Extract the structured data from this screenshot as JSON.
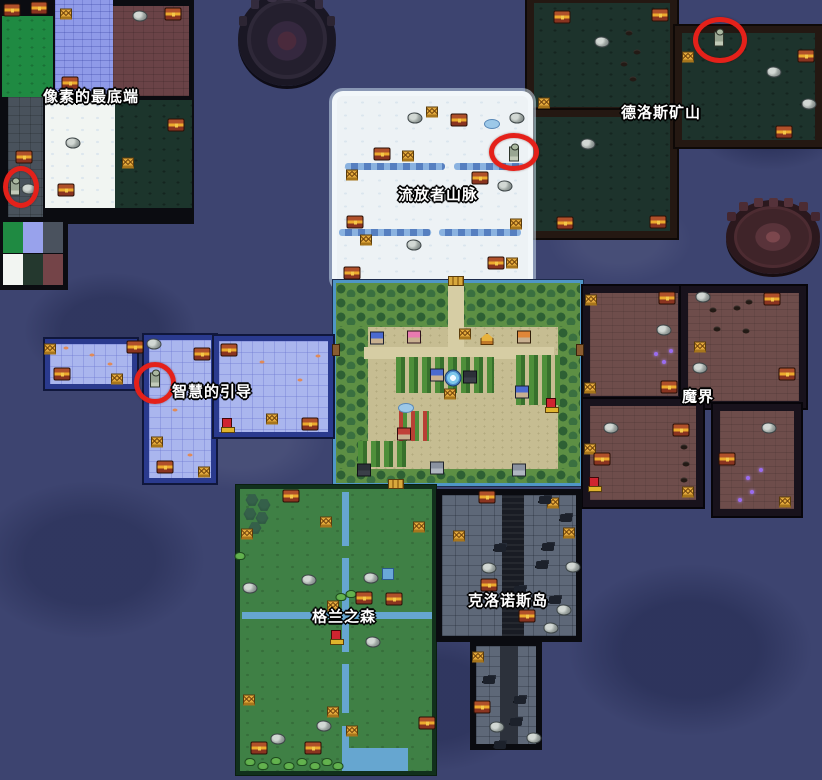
{
  "map": {
    "width": 822,
    "height": 780
  },
  "labels": [
    {
      "id": "pixel-bottom",
      "text": "像素的最底端",
      "x": 91,
      "y": 96
    },
    {
      "id": "delos-mine",
      "text": "德洛斯矿山",
      "x": 661,
      "y": 112
    },
    {
      "id": "exile-mountains",
      "text": "流放者山脉",
      "x": 438,
      "y": 194
    },
    {
      "id": "wisdom-guidance",
      "text": "智慧的引导",
      "x": 212,
      "y": 391
    },
    {
      "id": "demon-realm",
      "text": "魔界",
      "x": 698,
      "y": 396
    },
    {
      "id": "kronos-island",
      "text": "克洛诺斯岛",
      "x": 508,
      "y": 600
    },
    {
      "id": "gran-forest",
      "text": "格兰之森",
      "x": 344,
      "y": 616
    }
  ],
  "markers": {
    "red_circles": [
      {
        "x": 21,
        "y": 187,
        "rx": 18,
        "ry": 21
      },
      {
        "x": 514,
        "y": 152,
        "rx": 25,
        "ry": 19
      },
      {
        "x": 720,
        "y": 40,
        "rx": 27,
        "ry": 23
      },
      {
        "x": 155,
        "y": 383,
        "rx": 21,
        "ry": 21
      }
    ]
  },
  "icons": {
    "chest": "treasure-chest-icon",
    "sign": "gold-marker-icon",
    "rock": "rock-icon",
    "statue": "statue-icon",
    "totem": "red-totem-icon",
    "bush": "bush-icon",
    "pine": "pine-tree-icon",
    "sparkle": "purple-sparkle-icon",
    "orespot": "ore-icon",
    "fish": "fish-icon",
    "debris": "debris-icon",
    "pond": "pond-icon",
    "bluesq": "water-tile-icon",
    "dock": "dock-icon",
    "bridge": "bridge-icon",
    "fountain": "fountain-icon",
    "tent": "tent-icon",
    "houseblue": "house-icon",
    "housepink": "house-icon",
    "houseorange": "house-icon",
    "housered": "house-icon",
    "housedark": "house-icon",
    "housegray": "house-icon"
  },
  "colors": {
    "water": "#3d4470",
    "red_marker": "#e4211a",
    "label_text": "#ffffff",
    "chest_gold": "#edab2e",
    "snow": "#edf2f5",
    "wisdom_floor": "#aab6ee",
    "mine_floor": "#1d332c",
    "demon_floor": "#6e4d4b",
    "kronos_floor": "#5e6878",
    "forest_floor": "#3f8045",
    "village_ground": "#c6bd92",
    "river": "#66a6d0"
  },
  "sprites": [
    {
      "t": "chest",
      "x": 12,
      "y": 10
    },
    {
      "t": "chest",
      "x": 39,
      "y": 8
    },
    {
      "t": "sign",
      "x": 66,
      "y": 14
    },
    {
      "t": "rock",
      "x": 140,
      "y": 16
    },
    {
      "t": "chest",
      "x": 173,
      "y": 14
    },
    {
      "t": "chest",
      "x": 70,
      "y": 83
    },
    {
      "t": "rock",
      "x": 73,
      "y": 143
    },
    {
      "t": "chest",
      "x": 66,
      "y": 190
    },
    {
      "t": "chest",
      "x": 176,
      "y": 125
    },
    {
      "t": "sign",
      "x": 128,
      "y": 163
    },
    {
      "t": "chest",
      "x": 24,
      "y": 157
    },
    {
      "t": "statue",
      "x": 15,
      "y": 188
    },
    {
      "t": "rock",
      "x": 29,
      "y": 189
    },
    {
      "t": "chest",
      "x": 562,
      "y": 17
    },
    {
      "t": "chest",
      "x": 660,
      "y": 15
    },
    {
      "t": "rock",
      "x": 602,
      "y": 42
    },
    {
      "t": "orespot",
      "x": 629,
      "y": 33
    },
    {
      "t": "orespot",
      "x": 637,
      "y": 52
    },
    {
      "t": "orespot",
      "x": 624,
      "y": 64
    },
    {
      "t": "orespot",
      "x": 633,
      "y": 79
    },
    {
      "t": "sign",
      "x": 544,
      "y": 103
    },
    {
      "t": "rock",
      "x": 588,
      "y": 144
    },
    {
      "t": "chest",
      "x": 565,
      "y": 223
    },
    {
      "t": "chest",
      "x": 658,
      "y": 222
    },
    {
      "t": "statue",
      "x": 719,
      "y": 39
    },
    {
      "t": "sign",
      "x": 688,
      "y": 57
    },
    {
      "t": "chest",
      "x": 806,
      "y": 56
    },
    {
      "t": "rock",
      "x": 774,
      "y": 72
    },
    {
      "t": "rock",
      "x": 809,
      "y": 104
    },
    {
      "t": "chest",
      "x": 784,
      "y": 132
    },
    {
      "t": "rock",
      "x": 415,
      "y": 118
    },
    {
      "t": "sign",
      "x": 432,
      "y": 112
    },
    {
      "t": "chest",
      "x": 459,
      "y": 120
    },
    {
      "t": "pond",
      "x": 492,
      "y": 124
    },
    {
      "t": "rock",
      "x": 517,
      "y": 118
    },
    {
      "t": "statue",
      "x": 514,
      "y": 154
    },
    {
      "t": "chest",
      "x": 382,
      "y": 154
    },
    {
      "t": "sign",
      "x": 408,
      "y": 156
    },
    {
      "t": "sign",
      "x": 352,
      "y": 175
    },
    {
      "t": "chest",
      "x": 480,
      "y": 178
    },
    {
      "t": "rock",
      "x": 505,
      "y": 186
    },
    {
      "t": "chest",
      "x": 355,
      "y": 222
    },
    {
      "t": "sign",
      "x": 516,
      "y": 224
    },
    {
      "t": "sign",
      "x": 366,
      "y": 240
    },
    {
      "t": "rock",
      "x": 414,
      "y": 245
    },
    {
      "t": "chest",
      "x": 496,
      "y": 263
    },
    {
      "t": "sign",
      "x": 512,
      "y": 263
    },
    {
      "t": "chest",
      "x": 352,
      "y": 273
    },
    {
      "t": "bridge",
      "x": 456,
      "y": 281
    },
    {
      "t": "houseblue",
      "x": 377,
      "y": 338
    },
    {
      "t": "housepink",
      "x": 414,
      "y": 337
    },
    {
      "t": "sign",
      "x": 465,
      "y": 334
    },
    {
      "t": "tent",
      "x": 487,
      "y": 339
    },
    {
      "t": "houseorange",
      "x": 524,
      "y": 337
    },
    {
      "t": "dock",
      "x": 336,
      "y": 350
    },
    {
      "t": "dock",
      "x": 580,
      "y": 350
    },
    {
      "t": "fountain",
      "x": 453,
      "y": 378
    },
    {
      "t": "houseblue",
      "x": 437,
      "y": 375
    },
    {
      "t": "housedark",
      "x": 470,
      "y": 377
    },
    {
      "t": "houseblue",
      "x": 522,
      "y": 392
    },
    {
      "t": "sign",
      "x": 450,
      "y": 394
    },
    {
      "t": "totem",
      "x": 551,
      "y": 404
    },
    {
      "t": "pond",
      "x": 406,
      "y": 408
    },
    {
      "t": "housered",
      "x": 404,
      "y": 434
    },
    {
      "t": "housedark",
      "x": 364,
      "y": 470
    },
    {
      "t": "housegray",
      "x": 519,
      "y": 470
    },
    {
      "t": "housegray",
      "x": 437,
      "y": 468
    },
    {
      "t": "bridge",
      "x": 396,
      "y": 484
    },
    {
      "t": "sign",
      "x": 50,
      "y": 349
    },
    {
      "t": "chest",
      "x": 62,
      "y": 374
    },
    {
      "t": "sign",
      "x": 117,
      "y": 379
    },
    {
      "t": "chest",
      "x": 135,
      "y": 347
    },
    {
      "t": "rock",
      "x": 154,
      "y": 344
    },
    {
      "t": "chest",
      "x": 202,
      "y": 354
    },
    {
      "t": "statue",
      "x": 155,
      "y": 380
    },
    {
      "t": "fish",
      "x": 92,
      "y": 355
    },
    {
      "t": "fish",
      "x": 110,
      "y": 364
    },
    {
      "t": "fish",
      "x": 66,
      "y": 348
    },
    {
      "t": "sign",
      "x": 157,
      "y": 442
    },
    {
      "t": "chest",
      "x": 165,
      "y": 467
    },
    {
      "t": "sign",
      "x": 204,
      "y": 472
    },
    {
      "t": "fish",
      "x": 175,
      "y": 410
    },
    {
      "t": "fish",
      "x": 190,
      "y": 455
    },
    {
      "t": "chest",
      "x": 229,
      "y": 350
    },
    {
      "t": "totem",
      "x": 227,
      "y": 424
    },
    {
      "t": "sign",
      "x": 272,
      "y": 419
    },
    {
      "t": "chest",
      "x": 310,
      "y": 424
    },
    {
      "t": "fish",
      "x": 262,
      "y": 362
    },
    {
      "t": "fish",
      "x": 300,
      "y": 380
    },
    {
      "t": "fish",
      "x": 246,
      "y": 398
    },
    {
      "t": "fish",
      "x": 318,
      "y": 356
    },
    {
      "t": "sign",
      "x": 591,
      "y": 300
    },
    {
      "t": "chest",
      "x": 667,
      "y": 298
    },
    {
      "t": "rock",
      "x": 664,
      "y": 330
    },
    {
      "t": "sparkle",
      "x": 656,
      "y": 354
    },
    {
      "t": "sparkle",
      "x": 664,
      "y": 362
    },
    {
      "t": "sparkle",
      "x": 671,
      "y": 351
    },
    {
      "t": "sign",
      "x": 590,
      "y": 388
    },
    {
      "t": "chest",
      "x": 669,
      "y": 387
    },
    {
      "t": "rock",
      "x": 703,
      "y": 297
    },
    {
      "t": "orespot",
      "x": 713,
      "y": 310
    },
    {
      "t": "orespot",
      "x": 737,
      "y": 308
    },
    {
      "t": "orespot",
      "x": 749,
      "y": 302
    },
    {
      "t": "orespot",
      "x": 717,
      "y": 329
    },
    {
      "t": "orespot",
      "x": 746,
      "y": 331
    },
    {
      "t": "sign",
      "x": 700,
      "y": 347
    },
    {
      "t": "chest",
      "x": 772,
      "y": 299
    },
    {
      "t": "chest",
      "x": 787,
      "y": 374
    },
    {
      "t": "rock",
      "x": 700,
      "y": 368
    },
    {
      "t": "rock",
      "x": 611,
      "y": 428
    },
    {
      "t": "chest",
      "x": 681,
      "y": 430
    },
    {
      "t": "sign",
      "x": 590,
      "y": 449
    },
    {
      "t": "chest",
      "x": 602,
      "y": 459
    },
    {
      "t": "totem",
      "x": 594,
      "y": 483
    },
    {
      "t": "orespot",
      "x": 684,
      "y": 447
    },
    {
      "t": "orespot",
      "x": 686,
      "y": 464
    },
    {
      "t": "orespot",
      "x": 684,
      "y": 480
    },
    {
      "t": "sign",
      "x": 688,
      "y": 492
    },
    {
      "t": "rock",
      "x": 769,
      "y": 428
    },
    {
      "t": "chest",
      "x": 727,
      "y": 459
    },
    {
      "t": "sparkle",
      "x": 748,
      "y": 478
    },
    {
      "t": "sparkle",
      "x": 761,
      "y": 470
    },
    {
      "t": "sparkle",
      "x": 752,
      "y": 492
    },
    {
      "t": "sparkle",
      "x": 740,
      "y": 500
    },
    {
      "t": "sign",
      "x": 785,
      "y": 502
    },
    {
      "t": "chest",
      "x": 487,
      "y": 497
    },
    {
      "t": "sign",
      "x": 553,
      "y": 503
    },
    {
      "t": "debris",
      "x": 545,
      "y": 500
    },
    {
      "t": "debris",
      "x": 566,
      "y": 518
    },
    {
      "t": "sign",
      "x": 459,
      "y": 536
    },
    {
      "t": "sign",
      "x": 569,
      "y": 533
    },
    {
      "t": "debris",
      "x": 500,
      "y": 548
    },
    {
      "t": "debris",
      "x": 548,
      "y": 547
    },
    {
      "t": "rock",
      "x": 489,
      "y": 568
    },
    {
      "t": "rock",
      "x": 573,
      "y": 567
    },
    {
      "t": "chest",
      "x": 489,
      "y": 585
    },
    {
      "t": "debris",
      "x": 520,
      "y": 590
    },
    {
      "t": "chest",
      "x": 527,
      "y": 616
    },
    {
      "t": "rock",
      "x": 564,
      "y": 610
    },
    {
      "t": "rock",
      "x": 551,
      "y": 628
    },
    {
      "t": "debris",
      "x": 555,
      "y": 600
    },
    {
      "t": "debris",
      "x": 542,
      "y": 565
    },
    {
      "t": "sign",
      "x": 478,
      "y": 657
    },
    {
      "t": "debris",
      "x": 489,
      "y": 680
    },
    {
      "t": "debris",
      "x": 520,
      "y": 700
    },
    {
      "t": "chest",
      "x": 482,
      "y": 707
    },
    {
      "t": "debris",
      "x": 516,
      "y": 722
    },
    {
      "t": "rock",
      "x": 497,
      "y": 727
    },
    {
      "t": "rock",
      "x": 534,
      "y": 738
    },
    {
      "t": "debris",
      "x": 500,
      "y": 745
    },
    {
      "t": "pine",
      "x": 252,
      "y": 500
    },
    {
      "t": "pine",
      "x": 264,
      "y": 505
    },
    {
      "t": "pine",
      "x": 250,
      "y": 514
    },
    {
      "t": "pine",
      "x": 262,
      "y": 518
    },
    {
      "t": "pine",
      "x": 255,
      "y": 528
    },
    {
      "t": "chest",
      "x": 291,
      "y": 496
    },
    {
      "t": "sign",
      "x": 247,
      "y": 534
    },
    {
      "t": "sign",
      "x": 326,
      "y": 522
    },
    {
      "t": "sign",
      "x": 419,
      "y": 527
    },
    {
      "t": "bluesq",
      "x": 388,
      "y": 574
    },
    {
      "t": "rock",
      "x": 250,
      "y": 588
    },
    {
      "t": "rock",
      "x": 309,
      "y": 580
    },
    {
      "t": "rock",
      "x": 371,
      "y": 578
    },
    {
      "t": "bush",
      "x": 341,
      "y": 597
    },
    {
      "t": "bush",
      "x": 351,
      "y": 594
    },
    {
      "t": "chest",
      "x": 364,
      "y": 598
    },
    {
      "t": "chest",
      "x": 394,
      "y": 599
    },
    {
      "t": "sign",
      "x": 333,
      "y": 606
    },
    {
      "t": "totem",
      "x": 336,
      "y": 636
    },
    {
      "t": "rock",
      "x": 373,
      "y": 642
    },
    {
      "t": "bush",
      "x": 240,
      "y": 556
    },
    {
      "t": "sign",
      "x": 249,
      "y": 700
    },
    {
      "t": "sign",
      "x": 333,
      "y": 712
    },
    {
      "t": "sign",
      "x": 352,
      "y": 731
    },
    {
      "t": "chest",
      "x": 427,
      "y": 723
    },
    {
      "t": "rock",
      "x": 324,
      "y": 726
    },
    {
      "t": "rock",
      "x": 278,
      "y": 739
    },
    {
      "t": "chest",
      "x": 259,
      "y": 748
    },
    {
      "t": "chest",
      "x": 313,
      "y": 748
    },
    {
      "t": "bush",
      "x": 250,
      "y": 762
    },
    {
      "t": "bush",
      "x": 263,
      "y": 766
    },
    {
      "t": "bush",
      "x": 276,
      "y": 761
    },
    {
      "t": "bush",
      "x": 289,
      "y": 766
    },
    {
      "t": "bush",
      "x": 302,
      "y": 762
    },
    {
      "t": "bush",
      "x": 315,
      "y": 766
    },
    {
      "t": "bush",
      "x": 327,
      "y": 762
    },
    {
      "t": "bush",
      "x": 338,
      "y": 766
    }
  ]
}
